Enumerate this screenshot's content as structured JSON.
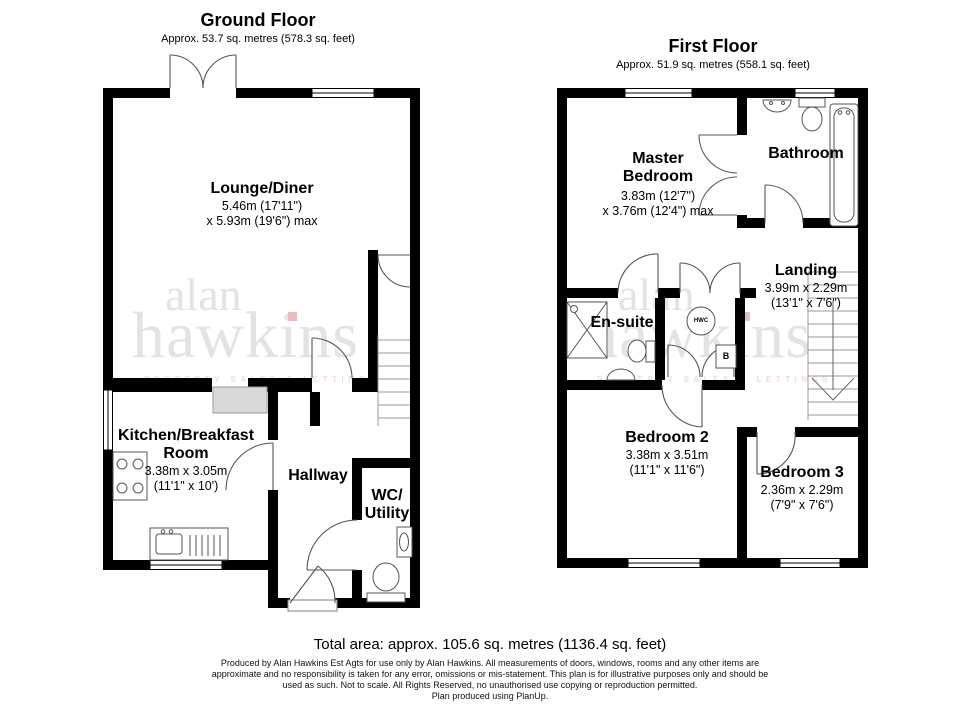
{
  "ground_floor": {
    "title": "Ground Floor",
    "subtitle": "Approx. 53.7 sq. metres (578.3 sq. feet)",
    "lounge": {
      "name": "Lounge/Diner",
      "dim1": "5.46m (17'11\")",
      "dim2": "x 5.93m (19'6\") max"
    },
    "kitchen": {
      "name": "Kitchen/Breakfast Room",
      "dim1": "3.38m x 3.05m",
      "dim2": "(11'1\" x 10')"
    },
    "hallway": {
      "name": "Hallway"
    },
    "wc": {
      "name_line1": "WC/",
      "name_line2": "Utility"
    }
  },
  "first_floor": {
    "title": "First Floor",
    "subtitle": "Approx. 51.9 sq. metres (558.1 sq. feet)",
    "master": {
      "name": "Master Bedroom",
      "dim1": "3.83m (12'7\")",
      "dim2": "x 3.76m (12'4\") max"
    },
    "bathroom": {
      "name": "Bathroom"
    },
    "ensuite": {
      "name": "En-suite"
    },
    "landing": {
      "name": "Landing",
      "dim1": "3.99m x 2.29m",
      "dim2": "(13'1\" x 7'6\")"
    },
    "bedroom2": {
      "name": "Bedroom 2",
      "dim1": "3.38m x 3.51m",
      "dim2": "(11'1\" x 11'6\")"
    },
    "bedroom3": {
      "name": "Bedroom 3",
      "dim1": "2.36m x 2.29m",
      "dim2": "(7'9\" x 7'6\")"
    },
    "labels": {
      "hwc": "HWC",
      "boiler": "B"
    }
  },
  "watermark": {
    "line1": "alan",
    "line2": "hawkins",
    "tagline": "PROPERTY SALES & LETTINGS",
    "dot_color": "#e9bcc0",
    "text_color": "#e3e3e3",
    "tagline_color": "#f0dbdc"
  },
  "footer": {
    "total": "Total area: approx. 105.6 sq. metres (1136.4 sq. feet)",
    "disclaimer": [
      "Produced by Alan Hawkins Est Agts for use only by Alan Hawkins. All measurements of doors, windows, rooms and any other items are",
      "approximate and no responsibility is taken for any error, omissions or mis-statement. This plan is for illustrative purposes only and should be",
      "used as such. Not to scale. All Rights Reserved, no unauthorised use copying or reproduction permitted.",
      "Plan produced using PlanUp."
    ]
  },
  "colors": {
    "wall": "#000000",
    "line": "#555555",
    "stair_line": "#999999",
    "worktop": "#d9d9d9"
  }
}
